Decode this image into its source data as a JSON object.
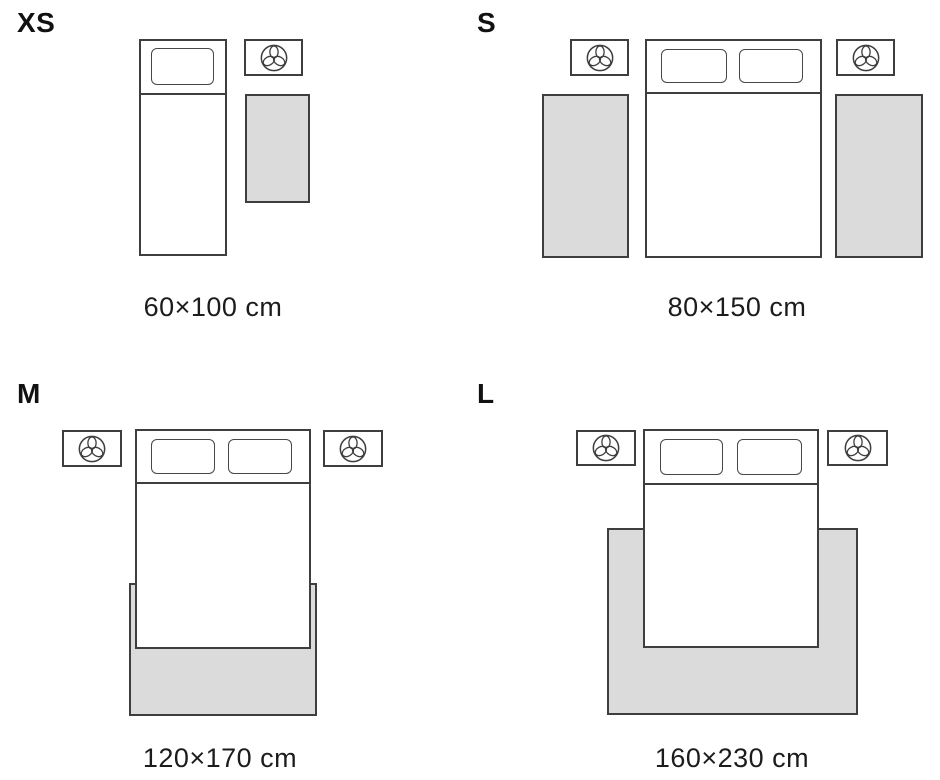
{
  "guide": {
    "colors": {
      "background": "#ffffff",
      "outline": "#3e3e3e",
      "rug_fill": "#dbdbdb",
      "text": "#1c1c1c"
    },
    "icons": {
      "nightstand_icon": "plant-icon"
    },
    "sections": [
      {
        "id": "xs",
        "label": "XS",
        "caption": "60×100 cm"
      },
      {
        "id": "s",
        "label": "S",
        "caption": "80×150 cm"
      },
      {
        "id": "m",
        "label": "M",
        "caption": "120×170 cm"
      },
      {
        "id": "l",
        "label": "L",
        "caption": "160×230 cm"
      }
    ]
  }
}
